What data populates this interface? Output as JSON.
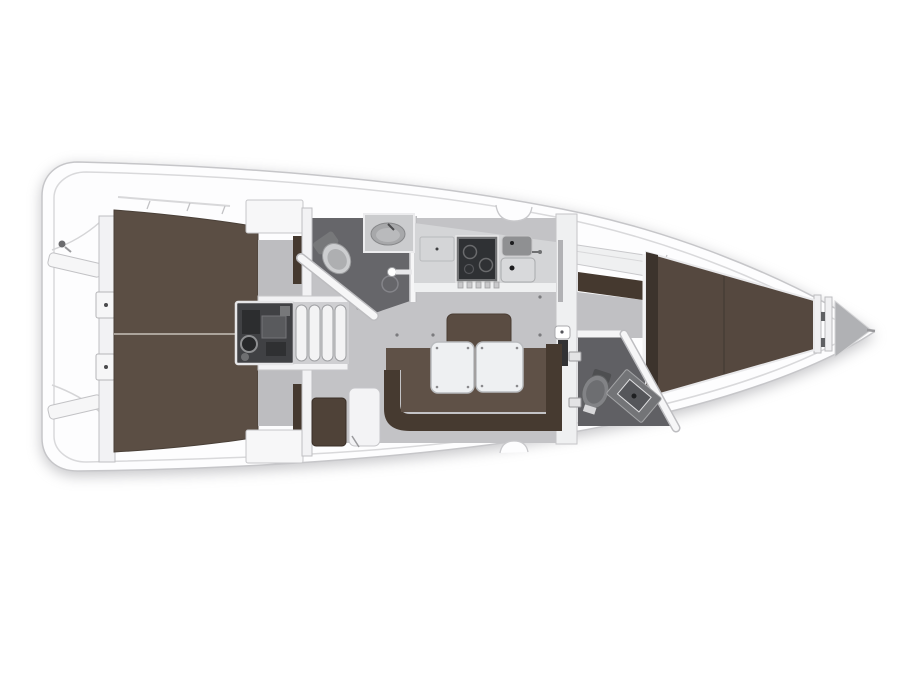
{
  "plan": {
    "subject": "sailing-yacht-interior-floor-plan",
    "orientation": "bow-right",
    "background": "#ffffff"
  },
  "colors": {
    "hull_fill": "#fdfdfe",
    "hull_stroke": "#c6c6c9",
    "inner_line": "#d9d9db",
    "wall": "#f2f2f4",
    "wall_edge": "#b9b9bd",
    "berth_aft": "#5b4e44",
    "berth_fwd": "#55483f",
    "berth_trim": "#e9e9eb",
    "berth_divider": "#b7b0a8",
    "headboard": "#3c332c",
    "wardrobe": "#45392f",
    "settee": "#5f5147",
    "settee_back": "#463a30",
    "backrest": "#5a4c42",
    "table": "#eef0f2",
    "table_edge": "#b9bbbe",
    "saloon_floor": "#c3c3c6",
    "cabin_floor": "#c0c0c3",
    "entry_floor": "#bdbdc0",
    "head_floor": "#66666a",
    "head_floor_fwd": "#606064",
    "counter": "#d4d5d7",
    "counter_trim": "#eff0f1",
    "stove_dark": "#2f3134",
    "stove_frame": "#717274",
    "sink_dark": "#8f9092",
    "sink_light": "#d8d9db",
    "engine_bg": "#404144",
    "engine_dark": "#2c2d2f",
    "engine_mid": "#595a5d",
    "steps": "#f3f3f4",
    "steps_back": "#cfcfd2",
    "anchor_gray": "#b0b1b4",
    "nav_seat": "#4f4238",
    "chart_table": "#f3f3f5",
    "toilet_gray": "#828386",
    "vanity_gray": "#737477",
    "fixture_light": "#cdced0",
    "deck_detail": "#d5d5d7"
  }
}
